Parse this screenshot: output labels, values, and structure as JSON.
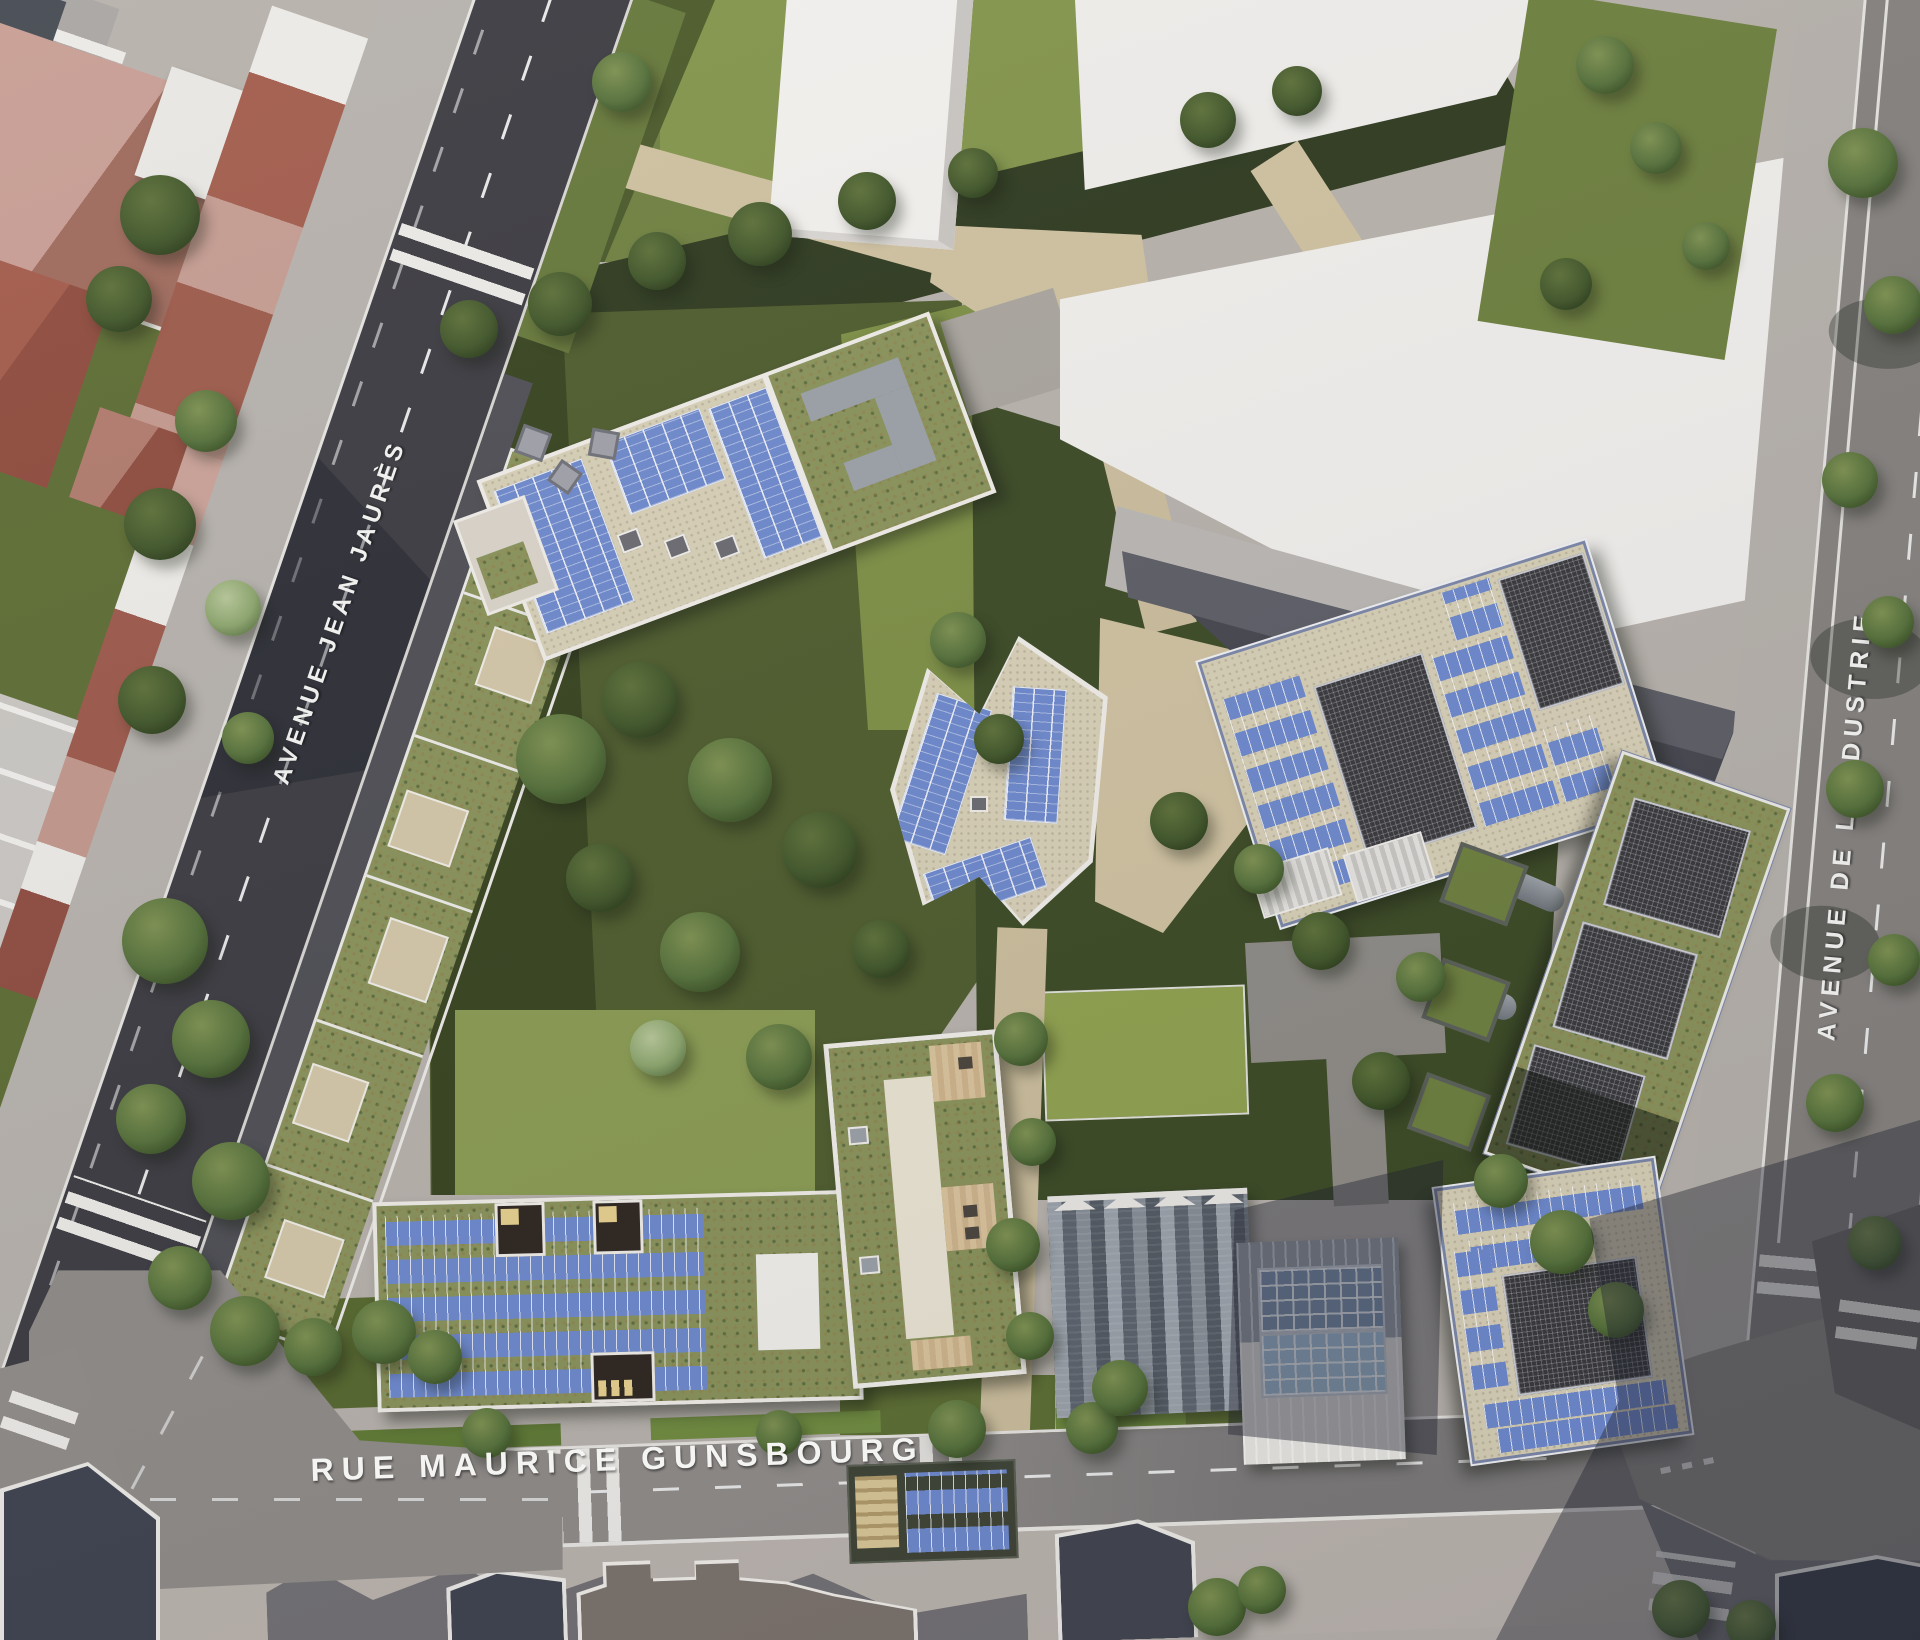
{
  "streets": {
    "avenue_jean_jaures": "AVENUE JEAN JAURÈS",
    "rue_maurice_gunsbourg": "RUE MAURICE GUNSBOURG",
    "avenue_de_l_industrie": "AVENUE DE L'INDUSTRIE"
  },
  "scene": {
    "type": "aerial-architectural-render",
    "description": "Bird's-eye render of an urban redevelopment block with green roofs, rooftop solar panels and landscaped gardens, bounded by Avenue Jean Jaurès, Rue Maurice Gunsbourg and Avenue de l'Industrie",
    "colors": {
      "asphalt_dark": "#3c3b41",
      "asphalt_light": "#8f8b88",
      "sidewalk": "#b7b1ab",
      "path_beige": "#cfc1a0",
      "lawn": "#7e9048",
      "lawn_dark": "#44522a",
      "green_roof": "#89925a",
      "solar_panel_blue": "#6d88cc",
      "roof_red": "#9c5a4a",
      "roof_pink": "#c59c92",
      "warehouse_white": "#f0eeeb",
      "slate_dark": "#46464f",
      "street_label_text": "#f4f4f2"
    }
  }
}
